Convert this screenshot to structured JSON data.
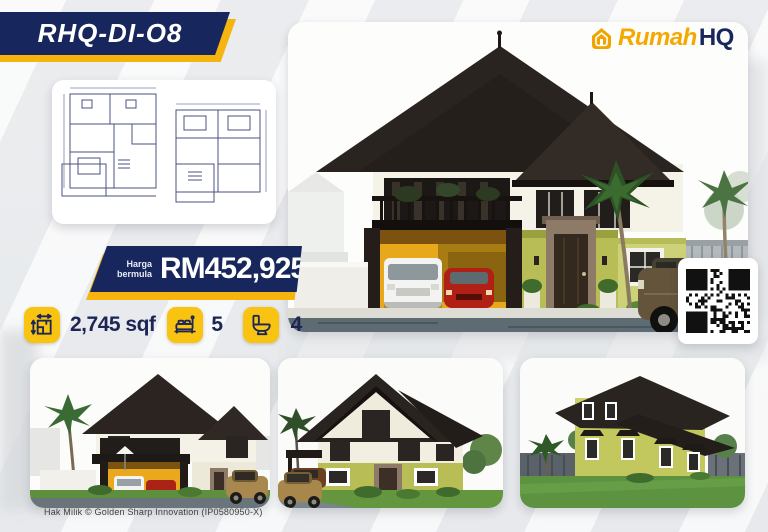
{
  "badge": {
    "model": "RHQ-DI-O8"
  },
  "logo": {
    "icon": "house-monogram-icon",
    "brand_first": "Rumah",
    "brand_second": "HQ"
  },
  "price": {
    "label_lines": [
      "Harga",
      "bermula"
    ],
    "amount": "RM452,925"
  },
  "specs": {
    "area": {
      "icon": "floorplan-measure-icon",
      "value": "2,745 sqf"
    },
    "bedrooms": {
      "icon": "bed-icon",
      "value": "5"
    },
    "bathrooms": {
      "icon": "toilet-icon",
      "value": "4"
    }
  },
  "gallery": {
    "floorplan": "two-storey-floor-plan-drawing",
    "main": "house-render-front-view",
    "thumbs": [
      "house-render-left-angle",
      "house-render-right-angle",
      "house-render-rear-side"
    ]
  },
  "qr": {
    "name": "qr-code"
  },
  "footer": {
    "copyright": "Hak Milik © Golden Sharp Innovation (IP0580950-X)"
  },
  "colors": {
    "navy": "#17265C",
    "yellow": "#F6B40E",
    "gold": "#F5A800"
  }
}
